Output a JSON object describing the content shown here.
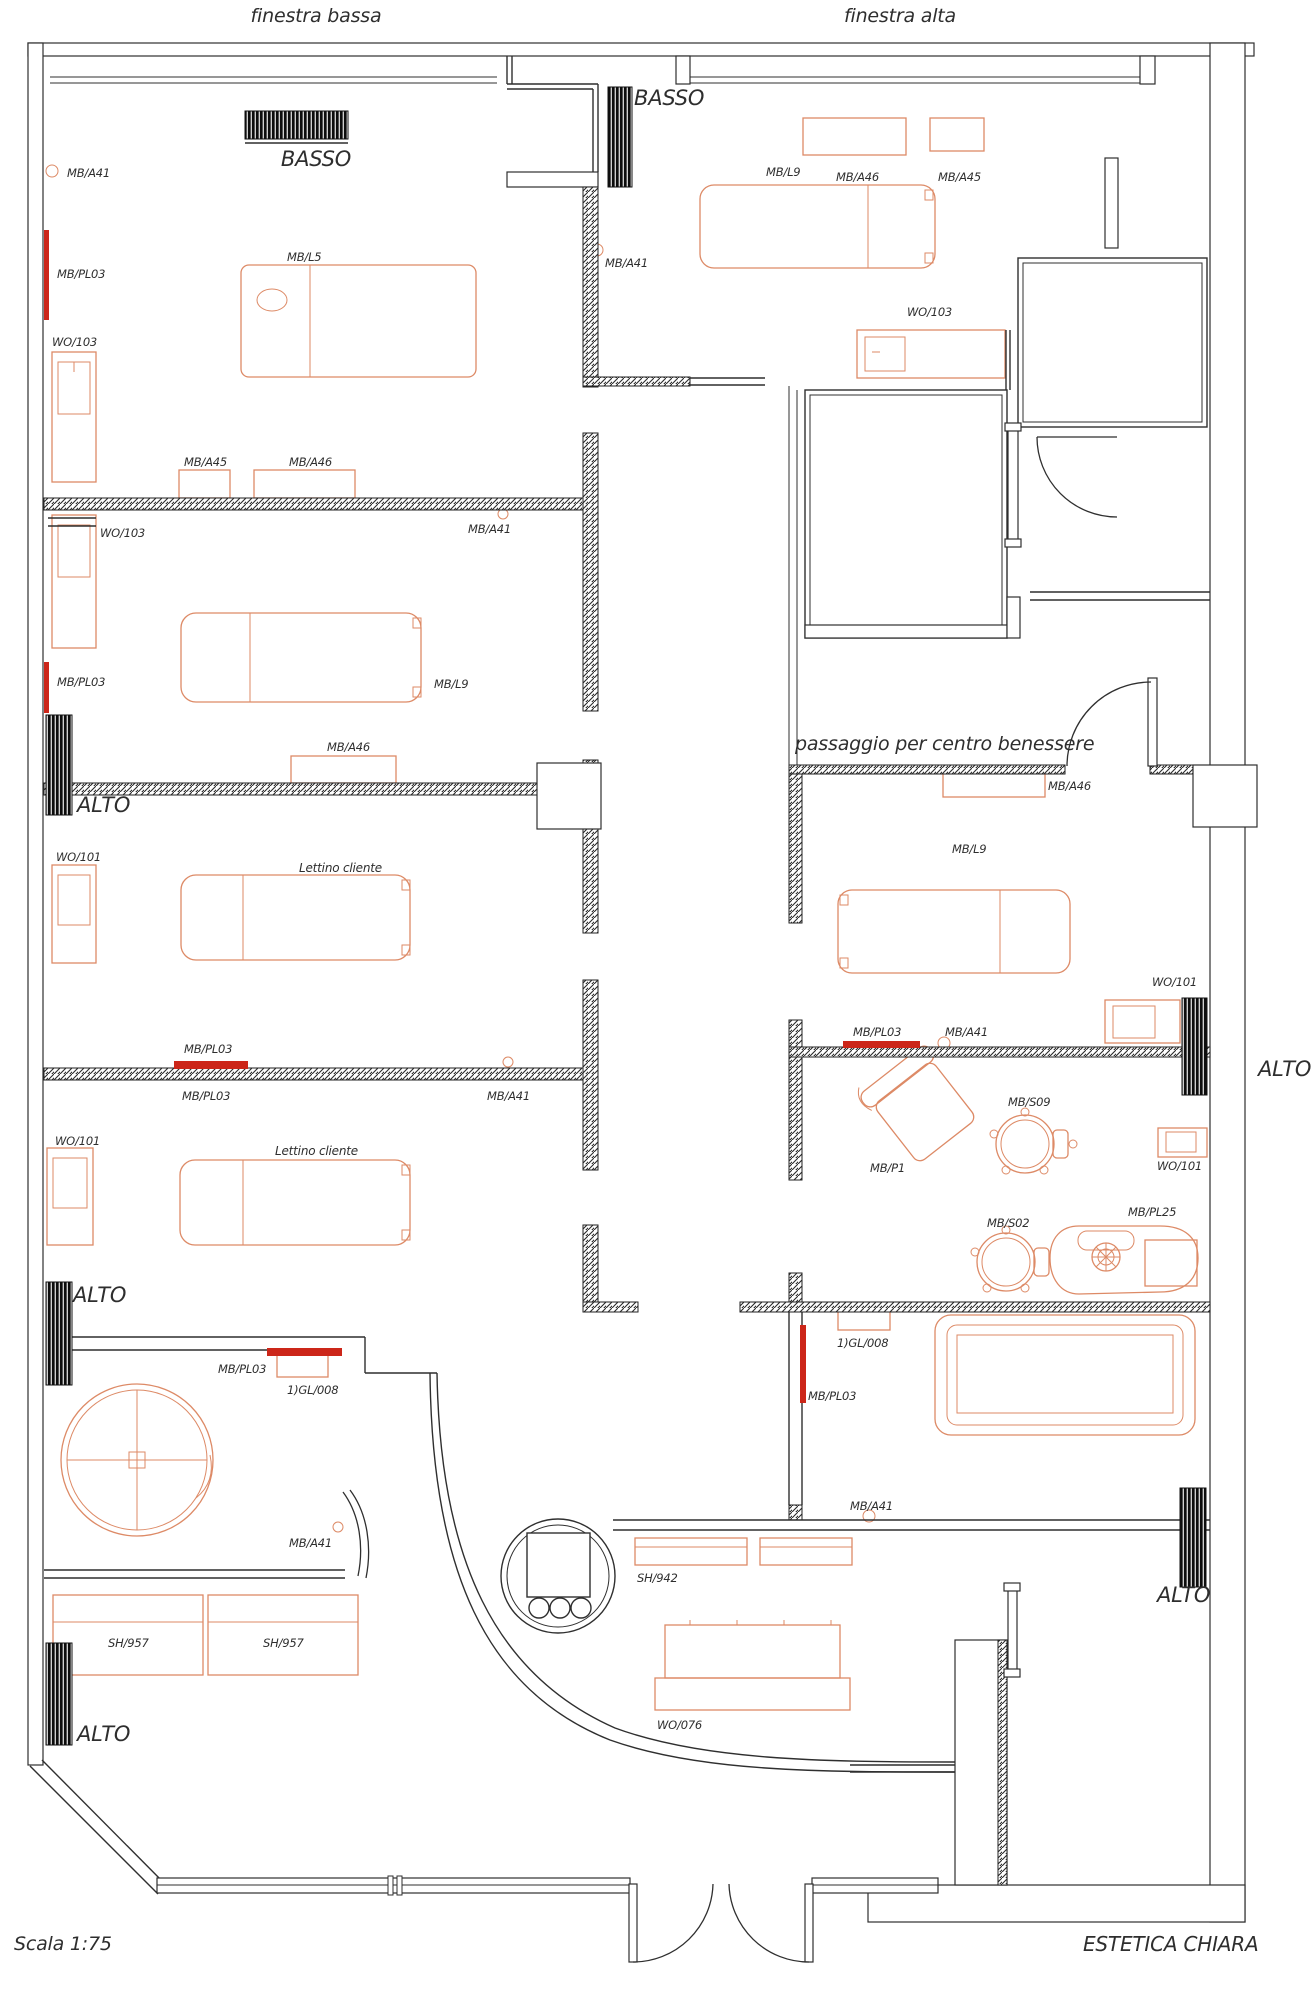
{
  "brand": "ESTETICA CHIARA",
  "scale_note": "Scala 1:75",
  "colors": {
    "background": "#ffffff",
    "wall": "#2f2f2f",
    "furniture_outline": "#dd8a66",
    "heater_red": "#cc2619",
    "text": "#2e2e2e",
    "window_hatch": "#0a0a0a"
  },
  "window_notes": {
    "top_left": "finestra bassa",
    "top_right": "finestra alta"
  },
  "labels": [
    {
      "id": "finestra-bassa",
      "text": "finestra bassa",
      "x": 316,
      "y": 22,
      "size": 19,
      "anchor": "middle"
    },
    {
      "id": "finestra-alta",
      "text": "finestra alta",
      "x": 900,
      "y": 22,
      "size": 19,
      "anchor": "middle"
    },
    {
      "id": "basso-1",
      "text": "BASSO",
      "x": 316,
      "y": 166,
      "size": 21,
      "anchor": "middle"
    },
    {
      "id": "basso-2",
      "text": "BASSO",
      "x": 634,
      "y": 105,
      "size": 21
    },
    {
      "id": "mb-a41-1",
      "text": "MB/A41",
      "x": 67,
      "y": 177,
      "size": 11.5
    },
    {
      "id": "mb-pl03-1",
      "text": "MB/PL03",
      "x": 57,
      "y": 278,
      "size": 11.5
    },
    {
      "id": "mb-l5",
      "text": "MB/L5",
      "x": 287,
      "y": 261,
      "size": 11.5
    },
    {
      "id": "wo-103-1",
      "text": "WO/103",
      "x": 52,
      "y": 346,
      "size": 11.5
    },
    {
      "id": "mb-a46-tr",
      "text": "MB/A46",
      "x": 836,
      "y": 181,
      "size": 11.5
    },
    {
      "id": "mb-a45-tr",
      "text": "MB/A45",
      "x": 938,
      "y": 181,
      "size": 11.5
    },
    {
      "id": "mb-l9-tr",
      "text": "MB/L9",
      "x": 766,
      "y": 176,
      "size": 11.5
    },
    {
      "id": "mb-a41-2",
      "text": "MB/A41",
      "x": 605,
      "y": 267,
      "size": 11.5
    },
    {
      "id": "wo-103-2",
      "text": "WO/103",
      "x": 907,
      "y": 316,
      "size": 11.5
    },
    {
      "id": "mb-a45-l",
      "text": "MB/A45",
      "x": 184,
      "y": 466,
      "size": 11.5
    },
    {
      "id": "mb-a46-l",
      "text": "MB/A46",
      "x": 289,
      "y": 466,
      "size": 11.5
    },
    {
      "id": "wo-103-3",
      "text": "WO/103",
      "x": 100,
      "y": 537,
      "size": 11.5
    },
    {
      "id": "mb-a41-3",
      "text": "MB/A41",
      "x": 468,
      "y": 533,
      "size": 11.5
    },
    {
      "id": "mb-pl03-2",
      "text": "MB/PL03",
      "x": 57,
      "y": 686,
      "size": 11.5
    },
    {
      "id": "mb-l9-l",
      "text": "MB/L9",
      "x": 434,
      "y": 688,
      "size": 11.5
    },
    {
      "id": "mb-a46-2",
      "text": "MB/A46",
      "x": 327,
      "y": 751,
      "size": 11.5
    },
    {
      "id": "alto-1",
      "text": "ALTO",
      "x": 77,
      "y": 812,
      "size": 21
    },
    {
      "id": "wo-101-1",
      "text": "WO/101",
      "x": 56,
      "y": 861,
      "size": 11.5
    },
    {
      "id": "lettino-1",
      "text": "Lettino cliente",
      "x": 299,
      "y": 872,
      "size": 12
    },
    {
      "id": "passaggio",
      "text": "passaggio per centro benessere",
      "x": 795,
      "y": 750,
      "size": 19
    },
    {
      "id": "mb-a46-p",
      "text": "MB/A46",
      "x": 1048,
      "y": 790,
      "size": 11.5
    },
    {
      "id": "mb-l9-p",
      "text": "MB/L9",
      "x": 952,
      "y": 853,
      "size": 11.5
    },
    {
      "id": "wo-101-p",
      "text": "WO/101",
      "x": 1152,
      "y": 986,
      "size": 11.5
    },
    {
      "id": "mb-pl03-3",
      "text": "MB/PL03",
      "x": 184,
      "y": 1053,
      "size": 11.5
    },
    {
      "id": "mb-pl03-4",
      "text": "MB/PL03",
      "x": 182,
      "y": 1100,
      "size": 11.5
    },
    {
      "id": "mb-a41-4",
      "text": "MB/A41",
      "x": 487,
      "y": 1100,
      "size": 11.5
    },
    {
      "id": "mb-pl03-p",
      "text": "MB/PL03",
      "x": 853,
      "y": 1036,
      "size": 11.5
    },
    {
      "id": "mb-a41-p",
      "text": "MB/A41",
      "x": 945,
      "y": 1036,
      "size": 11.5
    },
    {
      "id": "alto-r",
      "text": "ALTO",
      "x": 1258,
      "y": 1076,
      "size": 21
    },
    {
      "id": "wo-101-2",
      "text": "WO/101",
      "x": 55,
      "y": 1145,
      "size": 11.5
    },
    {
      "id": "lettino-2",
      "text": "Lettino cliente",
      "x": 275,
      "y": 1155,
      "size": 12
    },
    {
      "id": "mb-s09",
      "text": "MB/S09",
      "x": 1008,
      "y": 1106,
      "size": 11.5
    },
    {
      "id": "mb-p1",
      "text": "MB/P1",
      "x": 870,
      "y": 1172,
      "size": 11.5
    },
    {
      "id": "wo-101-3",
      "text": "WO/101",
      "x": 1157,
      "y": 1170,
      "size": 11.5
    },
    {
      "id": "mb-s02",
      "text": "MB/S02",
      "x": 987,
      "y": 1227,
      "size": 11.5
    },
    {
      "id": "mb-pl25",
      "text": "MB/PL25",
      "x": 1128,
      "y": 1216,
      "size": 11.5
    },
    {
      "id": "alto-2",
      "text": "ALTO",
      "x": 73,
      "y": 1302,
      "size": 21
    },
    {
      "id": "gl-008-1",
      "text": "1)GL/008",
      "x": 837,
      "y": 1347,
      "size": 11.5
    },
    {
      "id": "mb-pl03-5",
      "text": "MB/PL03",
      "x": 218,
      "y": 1373,
      "size": 11.5
    },
    {
      "id": "gl-008-2",
      "text": "1)GL/008",
      "x": 287,
      "y": 1394,
      "size": 11.5
    },
    {
      "id": "mb-pl03-6",
      "text": "MB/PL03",
      "x": 808,
      "y": 1400,
      "size": 11.5
    },
    {
      "id": "mb-a41-5",
      "text": "MB/A41",
      "x": 850,
      "y": 1510,
      "size": 11.5
    },
    {
      "id": "mb-a41-6",
      "text": "MB/A41",
      "x": 289,
      "y": 1547,
      "size": 11.5
    },
    {
      "id": "sh-942",
      "text": "SH/942",
      "x": 637,
      "y": 1582,
      "size": 11.5
    },
    {
      "id": "alto-br",
      "text": "ALTO",
      "x": 1157,
      "y": 1602,
      "size": 21
    },
    {
      "id": "sh-957-1",
      "text": "SH/957",
      "x": 108,
      "y": 1647,
      "size": 11.5
    },
    {
      "id": "sh-957-2",
      "text": "SH/957",
      "x": 263,
      "y": 1647,
      "size": 11.5
    },
    {
      "id": "wo-076",
      "text": "WO/076",
      "x": 657,
      "y": 1729,
      "size": 11.5
    },
    {
      "id": "alto-3",
      "text": "ALTO",
      "x": 77,
      "y": 1741,
      "size": 21
    },
    {
      "id": "scala",
      "text": "Scala 1:75",
      "x": 14,
      "y": 1950,
      "size": 19
    },
    {
      "id": "estetica",
      "text": "ESTETICA CHIARA",
      "x": 1083,
      "y": 1951,
      "size": 20
    }
  ]
}
